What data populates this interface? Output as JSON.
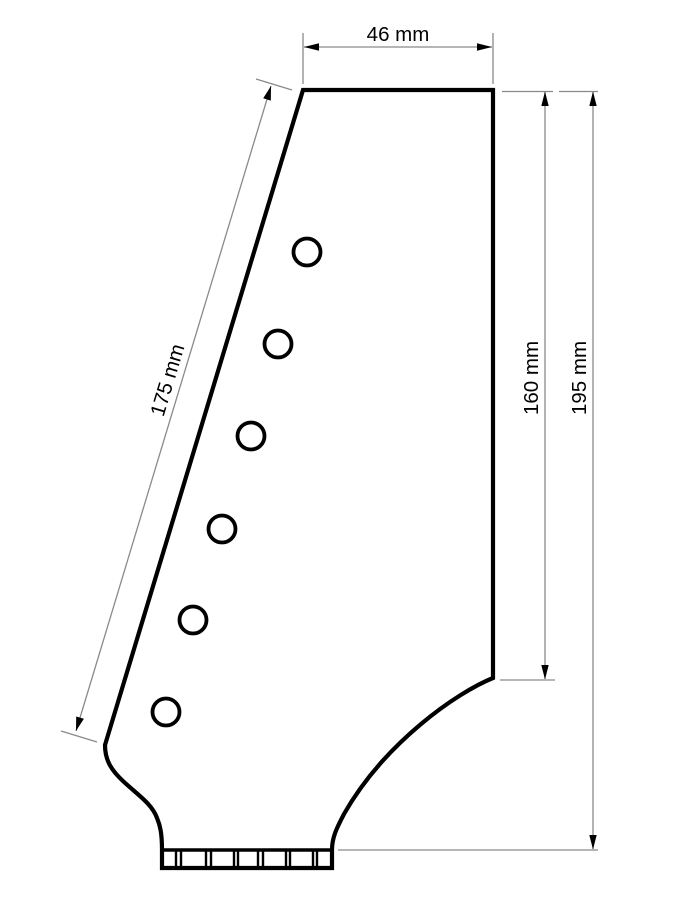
{
  "drawing": {
    "labels": {
      "width_top": "46 mm",
      "edge_left_slant": "175 mm",
      "height_inner_right": "160 mm",
      "height_overall": "195 mm"
    },
    "tuner_hole_count": 6,
    "nut_string_slot_count": 6,
    "colors": {
      "outline": "#000000",
      "dimension_lines": "#8a8a8a",
      "arrowheads": "#000000",
      "label_text": "#000000",
      "background": "#ffffff"
    }
  }
}
